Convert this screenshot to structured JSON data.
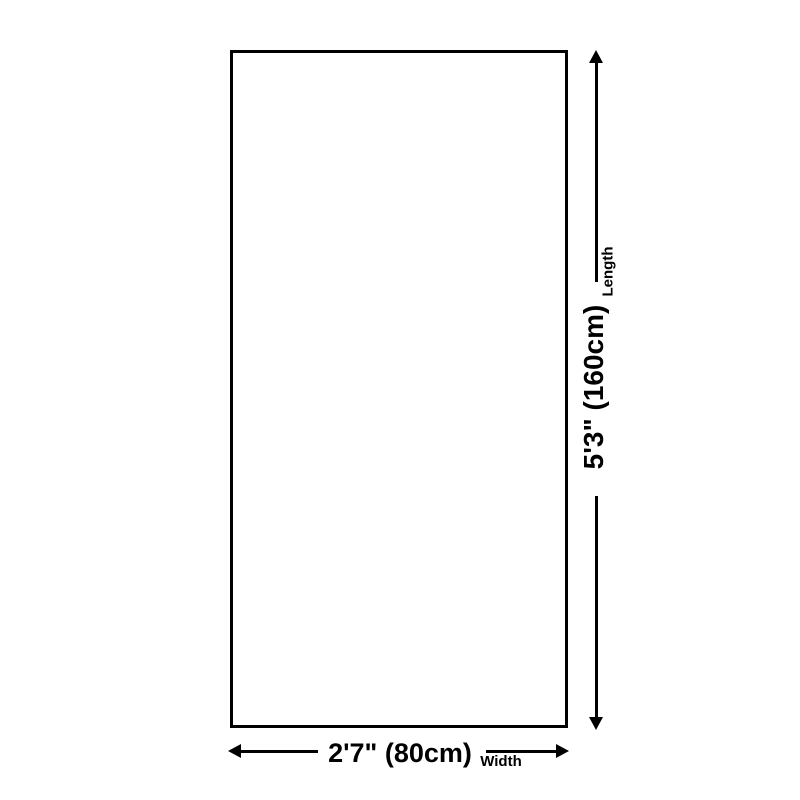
{
  "page": {
    "background_color": "#ffffff"
  },
  "diagram": {
    "type": "product-dimension-diagram",
    "line_color": "#000000",
    "text_color": "#000000",
    "length": {
      "value": "5'3\" (160cm)",
      "label": "Length"
    },
    "width": {
      "value": "2'7\" (80cm)",
      "label": "Width"
    }
  }
}
